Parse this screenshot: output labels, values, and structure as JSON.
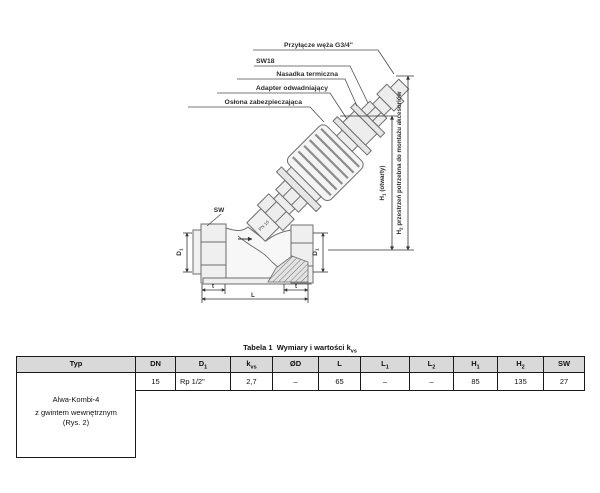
{
  "diagram": {
    "callouts": {
      "hose": "Przyłącze węża G3/4\"",
      "sw18": "SW18",
      "thermal_cap": "Nasadka termiczna",
      "drain_adapter": "Adapter odwadniający",
      "protective_cap": "Osłona zabezpieczająca"
    },
    "body_labels": {
      "sw": "SW",
      "pn": "PN 16"
    },
    "dims": {
      "d1": {
        "base": "D",
        "sub": "1"
      },
      "t": "t",
      "l": "L",
      "h1": {
        "base": "H",
        "sub": "1",
        "rest": " (otwarty)"
      },
      "h2": {
        "base": "H",
        "sub": "2",
        "rest": " przestrzeń potrzebna do montażu akcesoriów"
      }
    }
  },
  "table": {
    "title": {
      "text": "Tabela 1  Wymiary i wartości k",
      "sub": "vs"
    },
    "headers": [
      {
        "base": "Typ",
        "sub": ""
      },
      {
        "base": "DN",
        "sub": ""
      },
      {
        "base": "D",
        "sub": "1"
      },
      {
        "base": "k",
        "sub": "vs"
      },
      {
        "base": "ØD",
        "sub": ""
      },
      {
        "base": "L",
        "sub": ""
      },
      {
        "base": "L",
        "sub": "1"
      },
      {
        "base": "L",
        "sub": "2"
      },
      {
        "base": "H",
        "sub": "1"
      },
      {
        "base": "H",
        "sub": "2"
      },
      {
        "base": "SW",
        "sub": ""
      }
    ],
    "row": {
      "dn": "15",
      "d1": "Rp 1/2\"",
      "kvs": "2,7",
      "od": "–",
      "l": "65",
      "l1": "–",
      "l2": "–",
      "h1": "85",
      "h2": "135",
      "sw": "27"
    },
    "typ": {
      "line1": "Alwa-Kombi-4",
      "line2": "z gwintem wewnętrznym",
      "line3": "(Rys. 2)"
    }
  }
}
